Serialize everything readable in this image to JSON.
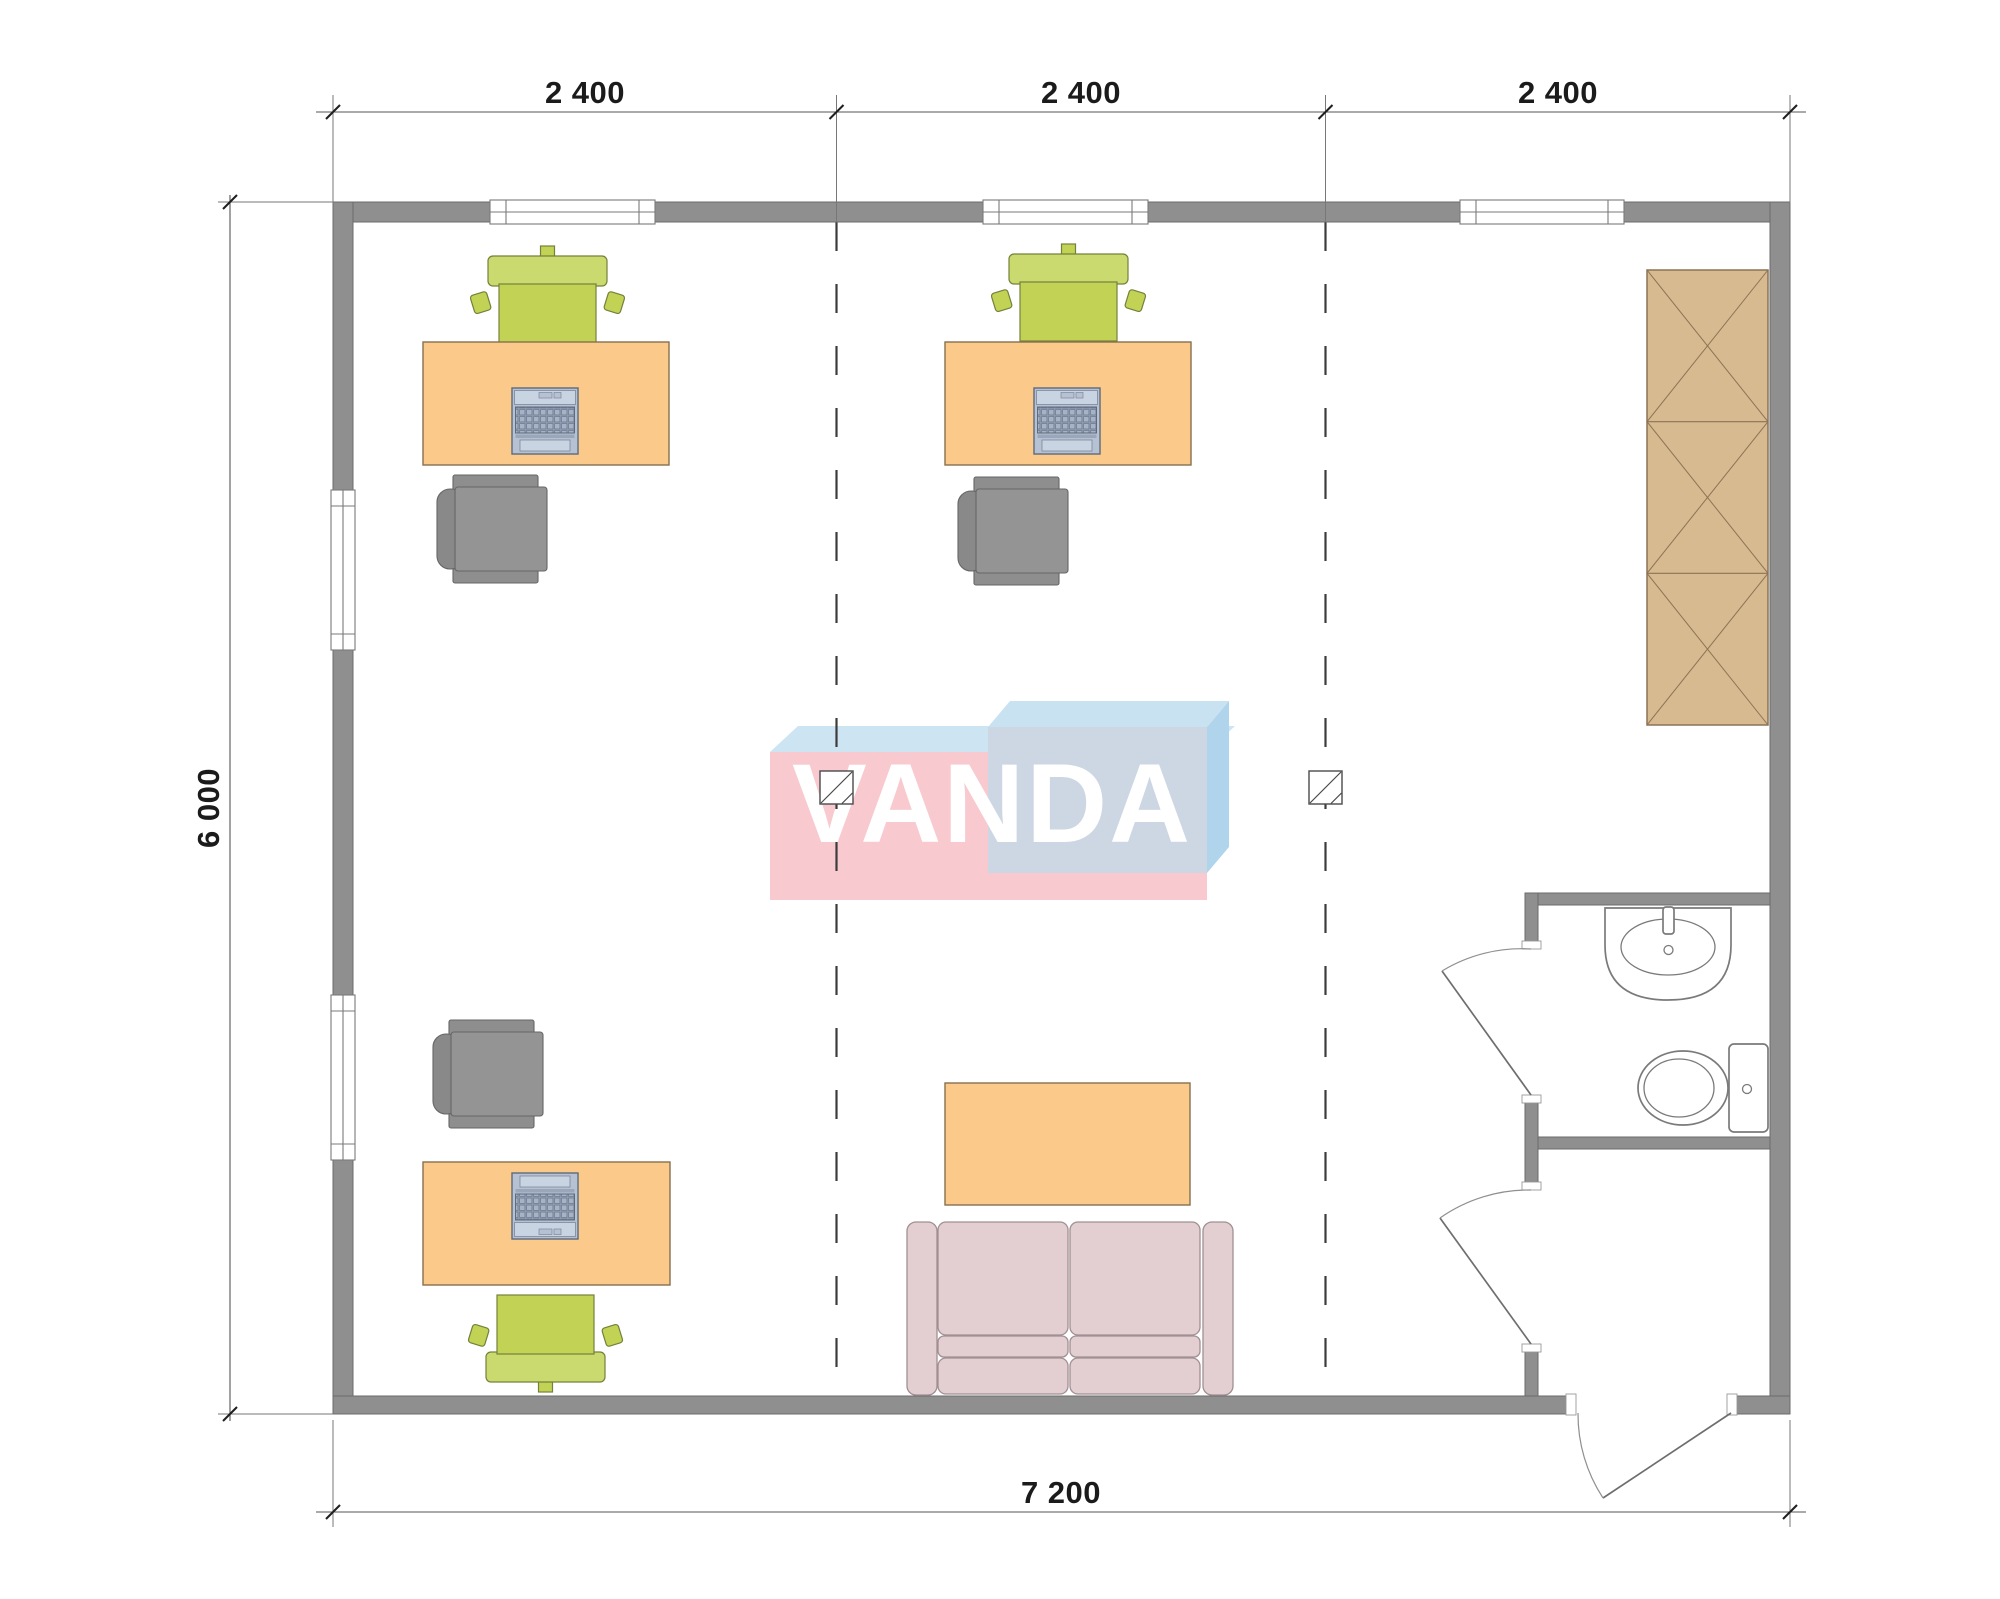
{
  "dimensions": {
    "top_spans": [
      {
        "label": "2 400"
      },
      {
        "label": "2 400"
      },
      {
        "label": "2 400"
      }
    ],
    "left_height": "6 000",
    "bottom_width": "7 200"
  },
  "watermark": {
    "text": "VANDA"
  },
  "colors": {
    "wall": "#8F8F8F",
    "desk_orange": "#FBC98A",
    "chair_green_back": "#CBDA6E",
    "chair_green_seat": "#C2D254",
    "chair_gray": "#949494",
    "sofa_pink": "#E3CFD2",
    "wardrobe_tan": "#D7BA8F",
    "laptop_blue": "#B6C2D4",
    "logo_pink": "#F8CACF",
    "logo_blue_top": "#CDE4F2",
    "logo_blue_top2": "#C9E2F1",
    "logo_blue_side": "#AFD4EB",
    "logo_slate": "#CDD6E3"
  },
  "icon_names": [
    "desk",
    "laptop",
    "office-chair",
    "visitor-chair",
    "sofa",
    "coffee-table",
    "wardrobe",
    "sink",
    "toilet",
    "door",
    "window",
    "structural-column",
    "grid-line",
    "dimension"
  ]
}
